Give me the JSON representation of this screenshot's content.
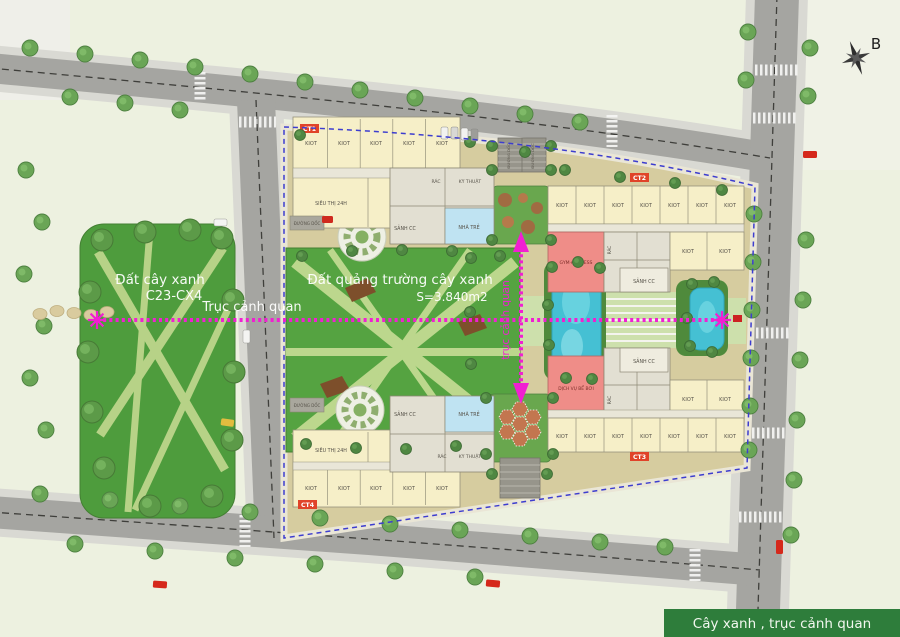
{
  "plan": {
    "compass_north": "B",
    "legend": "Cây xanh , trục cảnh quan",
    "park": {
      "name": "Đất cây xanh",
      "code": "C23-CX4"
    },
    "square": {
      "name": "Đất quảng trường cây xanh",
      "area": "S=3.840m2"
    },
    "axis": {
      "horizontal": "Trục cảnh quan",
      "vertical": "trục cảnh quan"
    },
    "buildings": {
      "ct1": "CT1",
      "ct2": "CT2",
      "ct3": "CT3",
      "ct4": "CT4"
    },
    "rooms": {
      "kiot": "KIOT",
      "supermarket": "SIÊU THỊ 24H",
      "lobby": "SẢNH CC",
      "trash": "RÁC",
      "technical": "KỸ THUẬT",
      "nursery": "NHÀ TRẺ",
      "ramp": "ĐƯỜNG DỐC",
      "gym": "GYM+FITNESS",
      "pool_service": "DỊCH VỤ BỂ BƠI"
    },
    "colors": {
      "axis_magenta": "#f11fd2",
      "boundary_blue": "#3d3dcf",
      "banner_green": "#2e7d3b",
      "park_green": "#4e9c3d",
      "pool_blue": "#45c0d3",
      "building_cream": "#f6efc8",
      "gym_pink": "#ef8d88",
      "nursery_blue": "#bfe3f2"
    }
  }
}
